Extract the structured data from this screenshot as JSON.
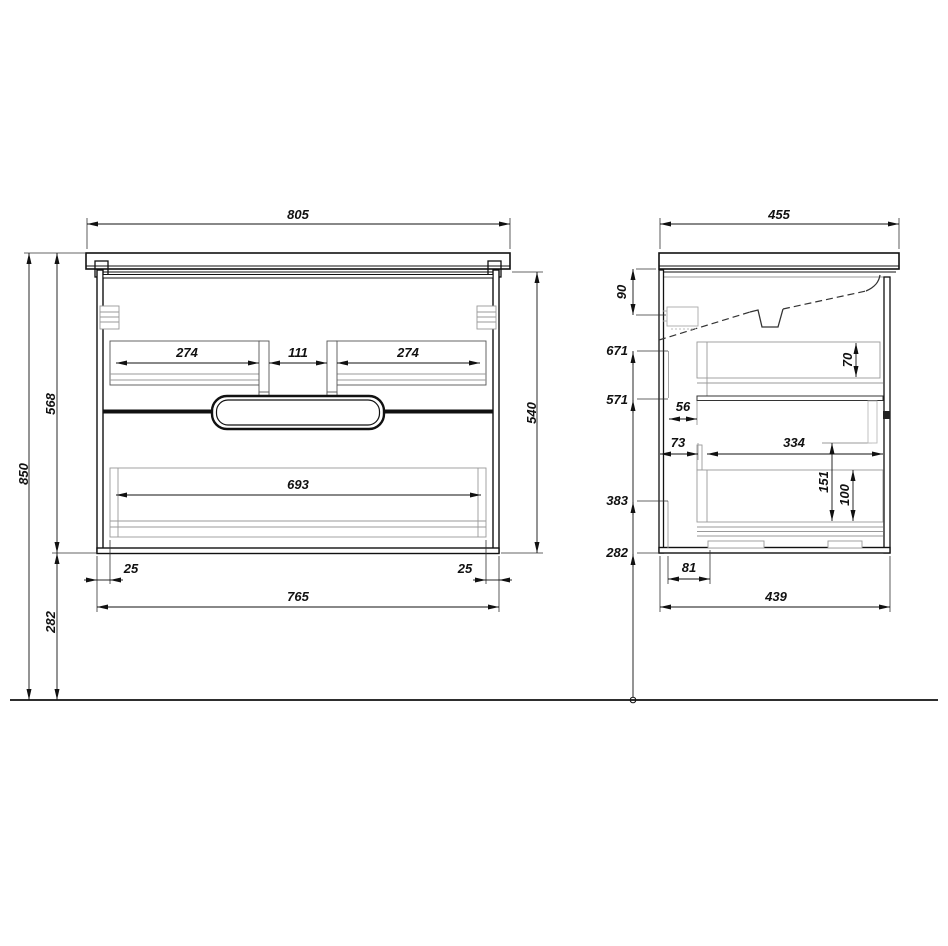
{
  "title": "vanity-cabinet-technical-drawing",
  "dims": {
    "front": {
      "width_top": "805",
      "rail_left": "274",
      "rail_gap": "111",
      "rail_right": "274",
      "rail_bottom": "693",
      "inset_left": "25",
      "inset_right": "25",
      "body_width": "765",
      "body_height": "540",
      "total_height": "850",
      "unit_height": "568",
      "clearance": "282"
    },
    "side": {
      "depth_top": "455",
      "apron_drop": "90",
      "level_top": "671",
      "level_divider": "571",
      "level_drawer": "383",
      "level_bottom": "282",
      "inset_top_drawer": "56",
      "inset_bottom_drawer": "73",
      "inner_depth": "334",
      "back_height_top": "70",
      "front_height_bottom": "151",
      "back_height_bottom": "100",
      "notch_offset": "81",
      "body_depth": "439"
    }
  },
  "colors": {
    "line": "#111111",
    "detail": "#999999",
    "background": "#ffffff"
  }
}
